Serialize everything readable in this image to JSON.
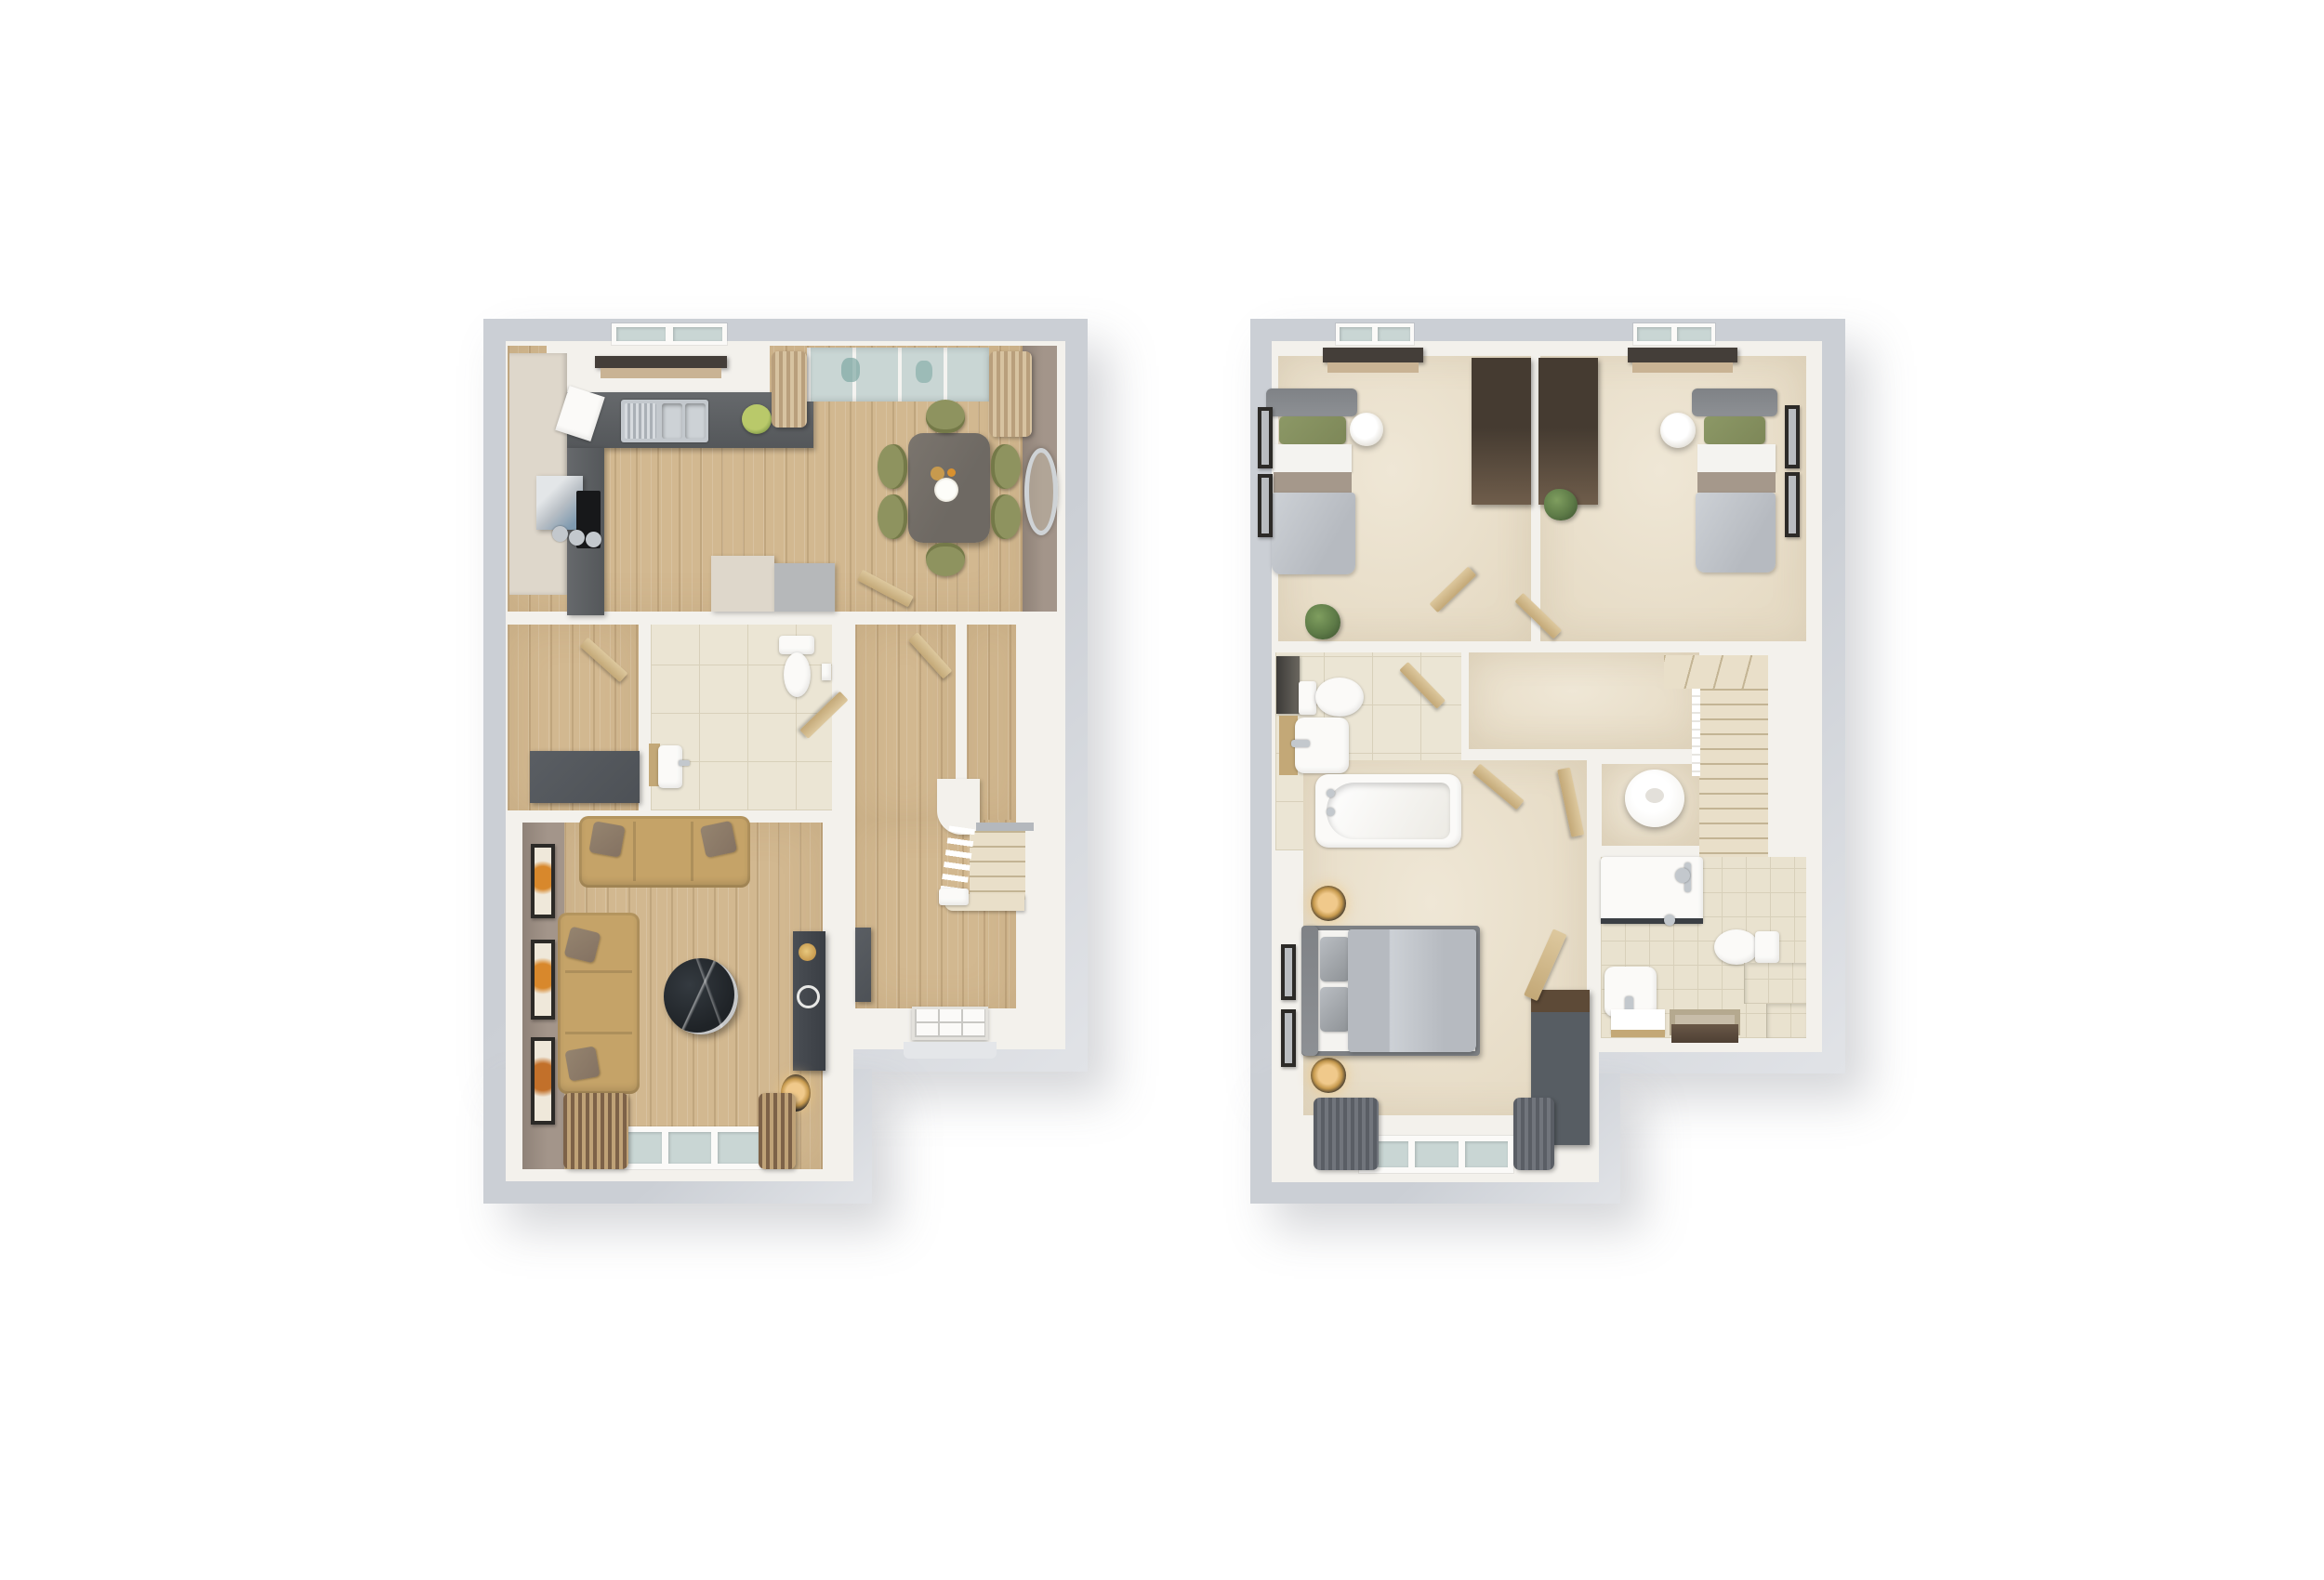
{
  "page": {
    "background": "#ffffff",
    "description": "Two dollhouse-style 3D floor plan renders of a house, shown top-down on a plain white page: ground floor on the left, first floor on the right. No text labels are rendered."
  },
  "palette": {
    "bg": "#ffffff",
    "plinth": "#cbcfd5",
    "plinth-light": "#e1e3e7",
    "wall": "#f3f1ec",
    "wall-dim": "#e9e5de",
    "taupe": "#a3958a",
    "taupe-dark": "#8f8278",
    "wood": "#d2b890",
    "wood-light": "#e0cdaa",
    "carpet": "#e6dbc5",
    "carpet-light": "#efe7d6",
    "tile": "#ebe5d4",
    "tile-warm": "#e9e2cf",
    "grout": "#d8d0ba",
    "counter": "#66696c",
    "counter-dark": "#54575a",
    "cabinet": "#ded7cb",
    "steel": "#b9bfc5",
    "steel-dark": "#8e979e",
    "glass": "#c9d6d4",
    "teal": "#7fa8a4",
    "door-wood": "#ddc89e",
    "door-wood-dark": "#c3a877",
    "stairs-carpet": "#e9dfc9",
    "stair-line": "#c3b494",
    "table-wood": "#6e6963",
    "chair": "#8e935f",
    "chair-dark": "#747948",
    "sofa": "#c5a368",
    "pillow": "#847262",
    "marble": "#1f2327",
    "media": "#3a3e44",
    "gold": "#c79a4e",
    "amber": "#f0c98b",
    "frame": "#2c2a27",
    "fixture": "#fbfaf8",
    "chrome": "#c3c8cd",
    "headboard": "#8d9094",
    "duvet": "#b6bac0",
    "duvet-light": "#cdd1d6",
    "sheet": "#f4f3f0",
    "bed-band": "#a5988b",
    "green-pillow": "#7d8758",
    "wardrobe": "#453b31",
    "wardrobe-light": "#6f5d4b",
    "dresser-top": "#5d4a37",
    "dresser-body": "#575d63",
    "pelmet": "#443e39",
    "blind": "#c9b394",
    "curtain-dark": "#5a5e65",
    "curtain-dark2": "#71757c",
    "curtain-tan": "#b99f7c",
    "curtain-tan2": "#d7c3a1",
    "curtain-brown": "#7d6248",
    "curtain-brown2": "#bfa277",
    "plant": "#5d7a47",
    "plant-dark": "#425934",
    "tank": "#f7f6f3",
    "console": "#4d5156"
  },
  "plans": {
    "ground": {
      "name": "ground-floor-plan",
      "aria": "Ground floor 3D floor plan",
      "rooms": [
        {
          "name": "kitchen-dining",
          "floor": "wood",
          "furniture": [
            "cream-cabinet-run",
            "l-shaped-grey-counter",
            "double-steel-sink",
            "fruit-bowl",
            "steel-appliance",
            "hob-with-pans",
            "chopping-board",
            "kitchen-window",
            "dark-pelmet-blind",
            "glazed-french-doors",
            "two-curtain-piles",
            "dining-table",
            "six-olive-chairs",
            "gold-vase",
            "white-flowers",
            "round-wall-mirror",
            "storage-units"
          ]
        },
        {
          "name": "store",
          "floor": "wood",
          "furniture": [
            "dark-console-table",
            "door"
          ]
        },
        {
          "name": "wc",
          "floor": "tile",
          "furniture": [
            "toilet",
            "basin-with-shelf",
            "toilet-roll-holder",
            "door"
          ]
        },
        {
          "name": "inner-hall",
          "floor": "wood",
          "furniture": [
            "doors"
          ]
        },
        {
          "name": "staircase",
          "floor": "stairs-carpet",
          "furniture": [
            "balustrade",
            "newel-post",
            "bullnose-step"
          ]
        },
        {
          "name": "entrance-hall",
          "floor": "wood",
          "furniture": [
            "slim-radiator-console",
            "glazed-front-door",
            "porch-step"
          ]
        },
        {
          "name": "living-room",
          "floor": "wood",
          "furniture": [
            "three-seat-sofa",
            "two-seat-sofa",
            "round-marble-coffee-table",
            "media-unit",
            "gold-speaker",
            "record-ring",
            "floor-lamp",
            "rear-window",
            "two-curtain-piles",
            "three-wall-pictures"
          ]
        }
      ]
    },
    "first": {
      "name": "first-floor-plan",
      "aria": "First floor 3D floor plan",
      "rooms": [
        {
          "name": "bedroom-1",
          "floor": "carpet",
          "furniture": [
            "single-bed",
            "green-pillow",
            "wardrobe",
            "white-pendant-shade",
            "window",
            "pelmet-blind",
            "two-wall-pictures",
            "plant",
            "door"
          ]
        },
        {
          "name": "bedroom-2",
          "floor": "carpet",
          "furniture": [
            "single-bed",
            "green-pillow",
            "wardrobe",
            "white-pendant-shade",
            "window",
            "pelmet-blind",
            "two-wall-pictures",
            "plant",
            "door"
          ]
        },
        {
          "name": "landing",
          "floor": "carpet",
          "furniture": [
            "doors"
          ]
        },
        {
          "name": "bathroom",
          "floor": "tile",
          "furniture": [
            "bath-with-taps",
            "toilet",
            "basin-with-shelf",
            "dark-towel-radiator",
            "door"
          ]
        },
        {
          "name": "master-bedroom",
          "floor": "carpet",
          "furniture": [
            "double-bed",
            "two-bedside-lamps",
            "dresser-wardrobe",
            "window",
            "two-grey-curtains",
            "two-wall-pictures",
            "door"
          ]
        },
        {
          "name": "en-suite",
          "floor": "tile",
          "furniture": [
            "shower-enclosure",
            "shower-mixer",
            "toilet",
            "basin",
            "white-mat",
            "bath-mat",
            "brown-towel",
            "tiled-steps",
            "door"
          ]
        },
        {
          "name": "airing-cupboard",
          "floor": "carpet",
          "furniture": [
            "hot-water-cylinder",
            "door"
          ]
        },
        {
          "name": "staircase",
          "floor": "stairs-carpet",
          "furniture": [
            "winder-steps",
            "balustrade"
          ]
        }
      ]
    }
  }
}
